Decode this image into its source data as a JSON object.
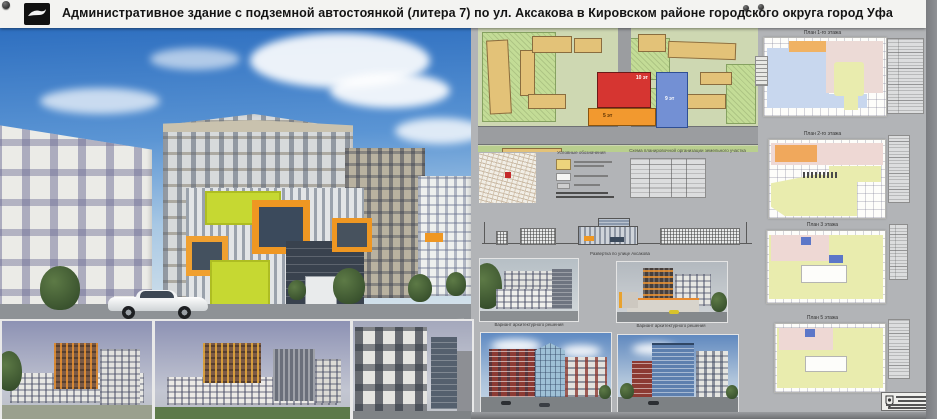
{
  "header": {
    "title": "Административное здание с подземной автостоянкой (литера 7) по ул. Аксакова в Кировском районе городского округа город Уфа"
  },
  "site_plan": {
    "caption": "Схема планировочной организации земельного участка",
    "legend_title": "Условные обозначения",
    "building_labels": {
      "main": "10 эт",
      "podium": "5 эт",
      "tower": "9 эт"
    }
  },
  "street_elevation": {
    "caption": "Развертка по улице Аксакова"
  },
  "renderings": {
    "captions": [
      "Вариант архитектурного решения",
      "Вариант архитектурного решения",
      "Вариант архитектурного решения",
      "Вариант архитектурного решения"
    ]
  },
  "floor_plans": [
    {
      "title": "План 1-го этажа"
    },
    {
      "title": "План 2-го этажа"
    },
    {
      "title": "План 3 этажа"
    },
    {
      "title": "План 5 этажа"
    }
  ],
  "colors": {
    "board": "#b2b4b7",
    "accent_orange": "#f0941f",
    "accent_lime": "#c6d832",
    "plan_red": "#d63531",
    "plan_blue": "#7390d4",
    "plan_orange": "#f2992f"
  }
}
